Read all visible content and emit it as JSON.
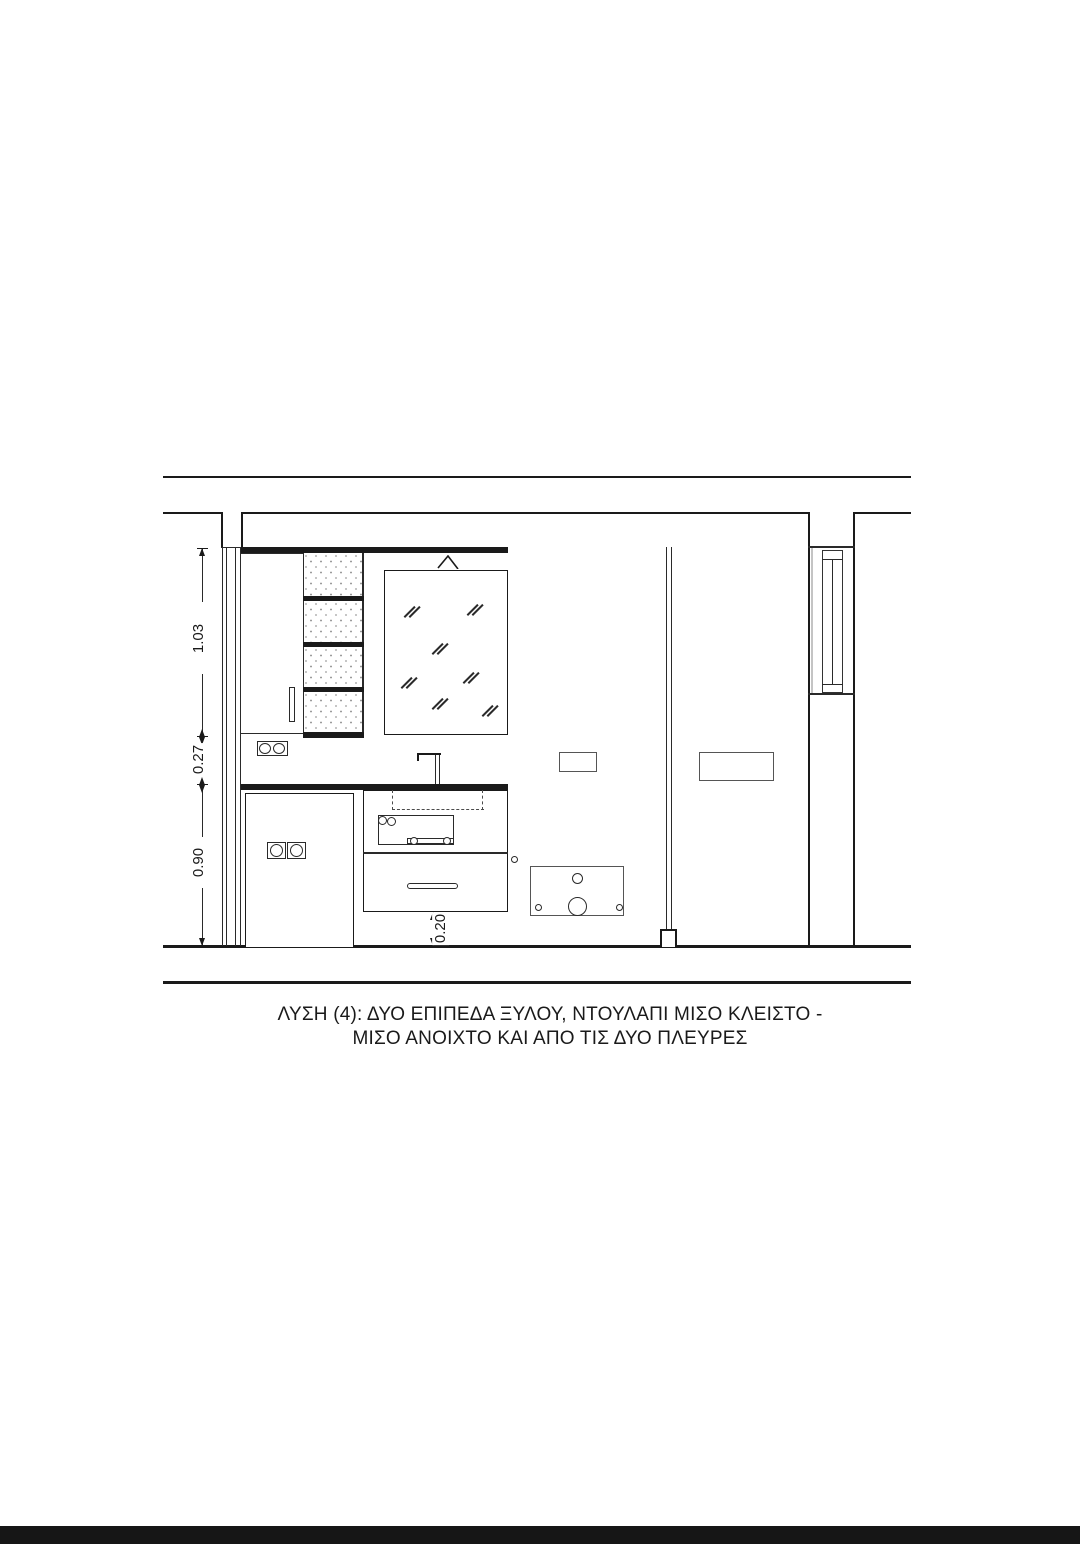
{
  "page": {
    "background": "#ffffff",
    "line_color": "#1a1a1a",
    "bottom_bar_color": "#161616"
  },
  "dimensions": {
    "upper": "1.03",
    "middle": "0.27",
    "lower": "0.90",
    "toe_kick": "0.20"
  },
  "caption": {
    "line1": "ΛΥΣΗ (4):  ΔΥΟ ΕΠΙΠΕΔΑ ΞΥΛΟΥ, ΝΤΟΥΛΑΠΙ ΜΙΣΟ  ΚΛΕΙΣΤΟ -",
    "line2": "ΜΙΣΟ ΑΝΟΙΧΤΟ ΚΑΙ ΑΠΟ ΤΙΣ ΔΥΟ ΠΛΕΥΡΕΣ"
  }
}
